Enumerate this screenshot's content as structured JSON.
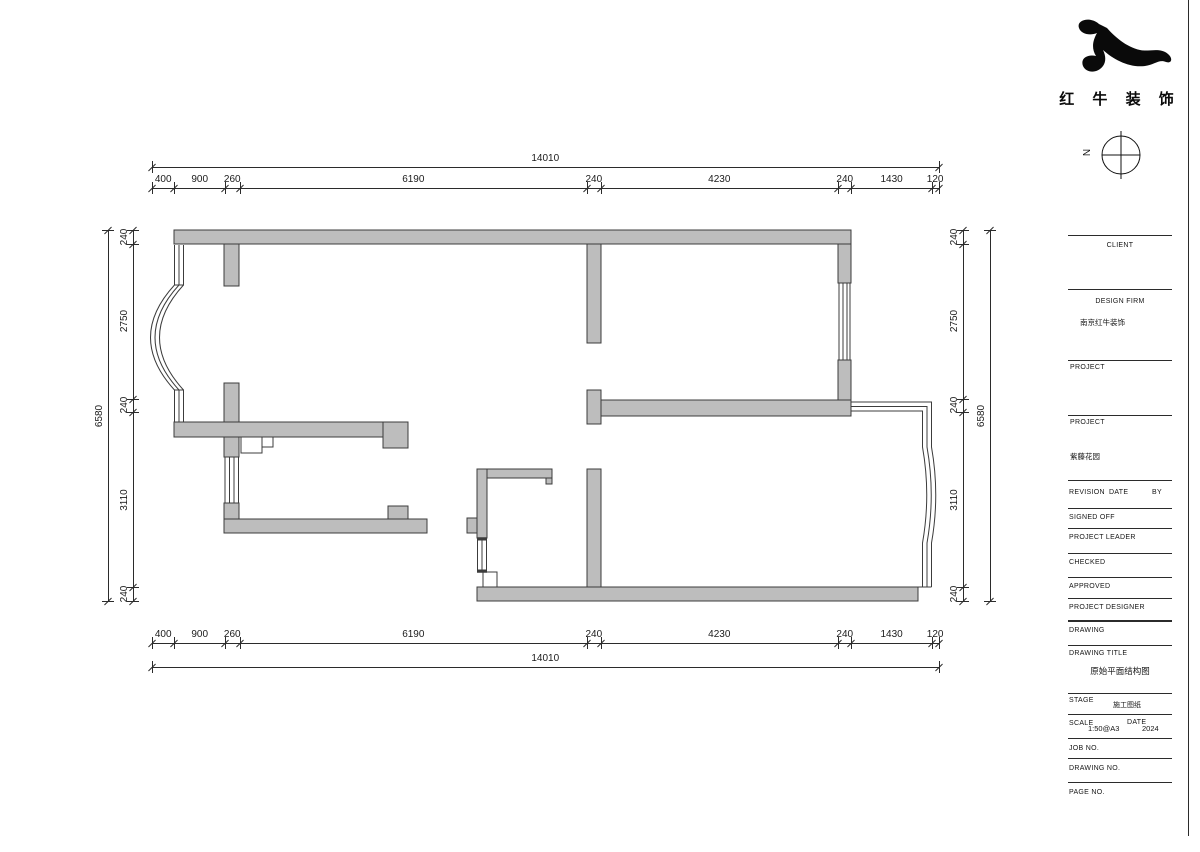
{
  "brand": {
    "name": "红 牛 装 饰"
  },
  "north_indicator": {
    "label": "N"
  },
  "dimensions": {
    "top": {
      "overall": "14010",
      "segments": [
        "400",
        "900",
        "260",
        "6190",
        "240",
        "4230",
        "240",
        "1430",
        "120"
      ]
    },
    "bottom": {
      "overall": "14010",
      "segments": [
        "400",
        "900",
        "260",
        "6190",
        "240",
        "4230",
        "240",
        "1430",
        "120"
      ]
    },
    "left": {
      "overall": "6580",
      "segments": [
        "240",
        "2750",
        "240",
        "3110",
        "240"
      ]
    },
    "right": {
      "overall": "6580",
      "segments": [
        "240",
        "2750",
        "240",
        "3110",
        "240"
      ]
    }
  },
  "title_block": {
    "client_label": "CLIENT",
    "design_firm_label": "DESIGN FIRM",
    "design_firm_value": "南京红牛装饰",
    "project1_label": "PROJECT",
    "project2_label": "PROJECT",
    "project2_value": "紫藤花园",
    "revision_label": "REVISION",
    "date_col_label": "DATE",
    "by_label": "BY",
    "signed_off_label": "SIGNED OFF",
    "project_leader_label": "PROJECT LEADER",
    "checked_label": "CHECKED",
    "approved_label": "APPROVED",
    "project_designer_label": "PROJECT DESIGNER",
    "drawing_label": "DRAWING",
    "drawing_title_label": "DRAWING TITLE",
    "drawing_title_value": "原始平面结构图",
    "stage_label": "STAGE",
    "stage_value": "施工图纸",
    "scale_label": "SCALE",
    "scale_value": "1:50@A3",
    "date_label": "DATE",
    "date_value": "2024",
    "job_no_label": "JOB NO.",
    "drawing_no_label": "DRAWING NO.",
    "page_no_label": "PAGE NO."
  }
}
